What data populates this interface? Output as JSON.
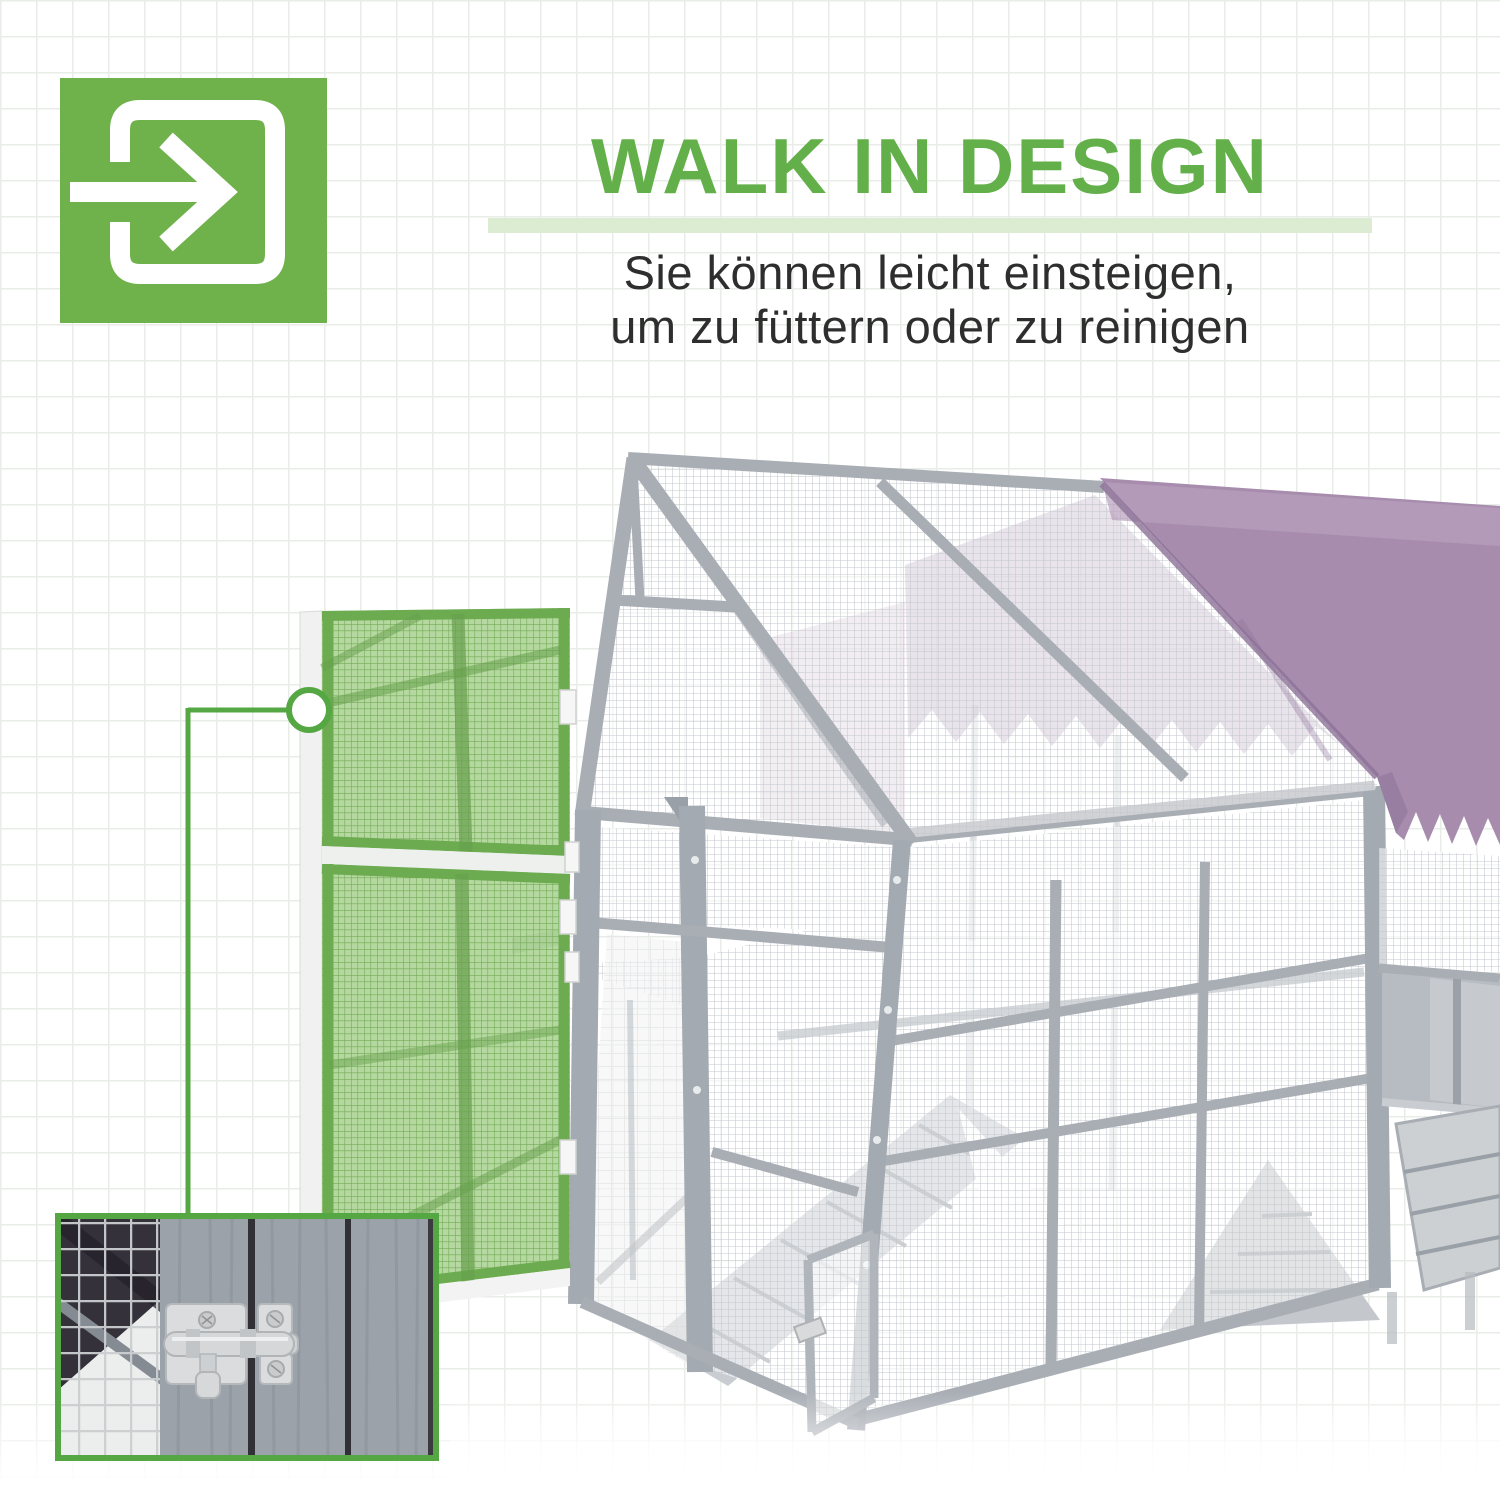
{
  "page": {
    "background_color": "#ffffff",
    "grid_line_color": "#e9ede8"
  },
  "header": {
    "icon": {
      "name": "walk-in-arrow-icon",
      "background_color": "#6fb24c",
      "glyph_color": "#ffffff"
    },
    "title": "WALK IN DESIGN",
    "title_color": "#63b04a",
    "underline_color": "#dcecd2",
    "subtitle_lines": [
      "Sie können leicht einsteigen,",
      "um zu füttern oder zu reinigen"
    ],
    "subtitle_color": "#2e2e2e"
  },
  "figure": {
    "name": "walk-in-chicken-run-render",
    "frame_color": "#a9aeb5",
    "mesh_color": "#c3c7cc",
    "roof_tarp_color": "#a78cae",
    "door_highlight_color": "#7cb75f",
    "callout_color": "#54a743",
    "inset": {
      "name": "door-latch-detail-photo",
      "border_color": "#54a743"
    }
  }
}
